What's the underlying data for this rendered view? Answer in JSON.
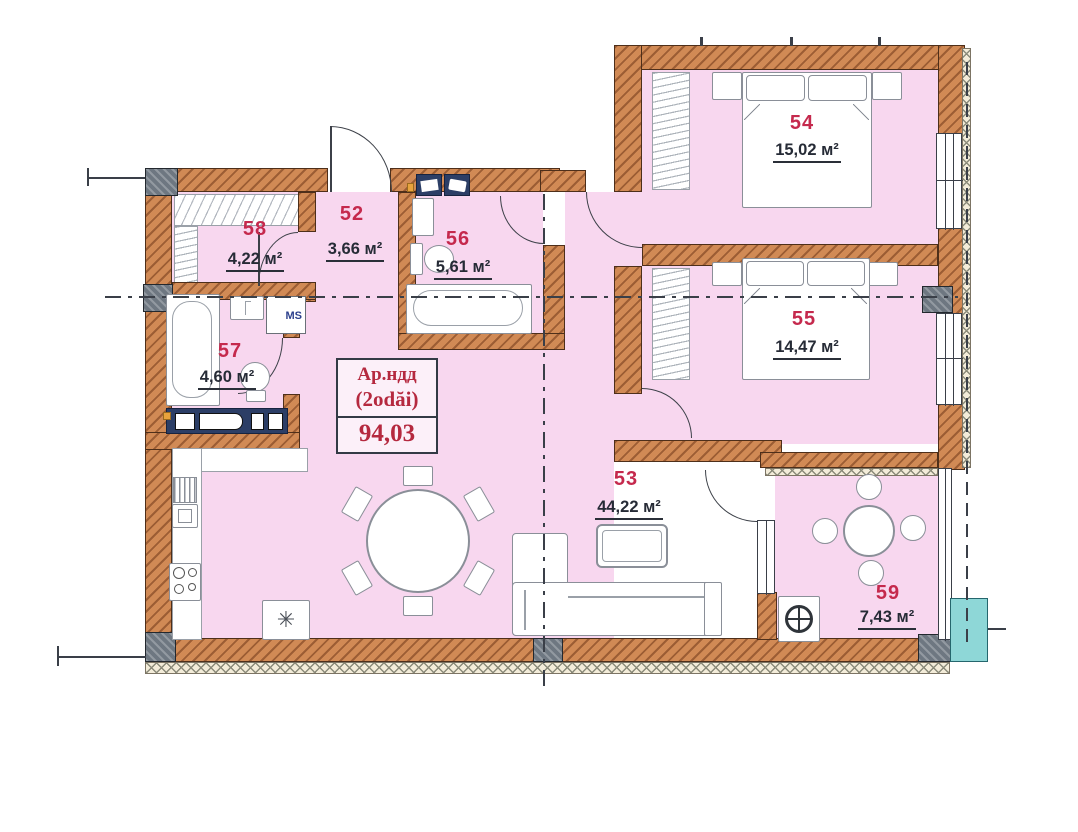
{
  "plan": {
    "type": "apartment-floor-plan",
    "title": {
      "line1": "Ар.ндд",
      "line2": "(2odăi)",
      "total_area": "94,03"
    },
    "rooms": {
      "r52": {
        "number": "52",
        "area": "3,66 м²"
      },
      "r53": {
        "number": "53",
        "area": "44,22 м²"
      },
      "r54": {
        "number": "54",
        "area": "15,02 м²"
      },
      "r55": {
        "number": "55",
        "area": "14,47 м²"
      },
      "r56": {
        "number": "56",
        "area": "5,61 м²"
      },
      "r57": {
        "number": "57",
        "area": "4,60 м²"
      },
      "r58": {
        "number": "58",
        "area": "4,22 м²"
      },
      "r59": {
        "number": "59",
        "area": "7,43 м²"
      }
    },
    "symbols": {
      "washing_machine": "MS",
      "appliance_asterisk": "✳"
    },
    "colors": {
      "floor_pink": "#f8d7ef",
      "wall_orange": "#d18a55",
      "room_number_red": "#c5294d",
      "area_text_dark": "#262b36",
      "title_red": "#b5293f",
      "ms_label_blue": "#2b3f8c",
      "exterior_unit_teal": "#8ed7d7"
    }
  }
}
